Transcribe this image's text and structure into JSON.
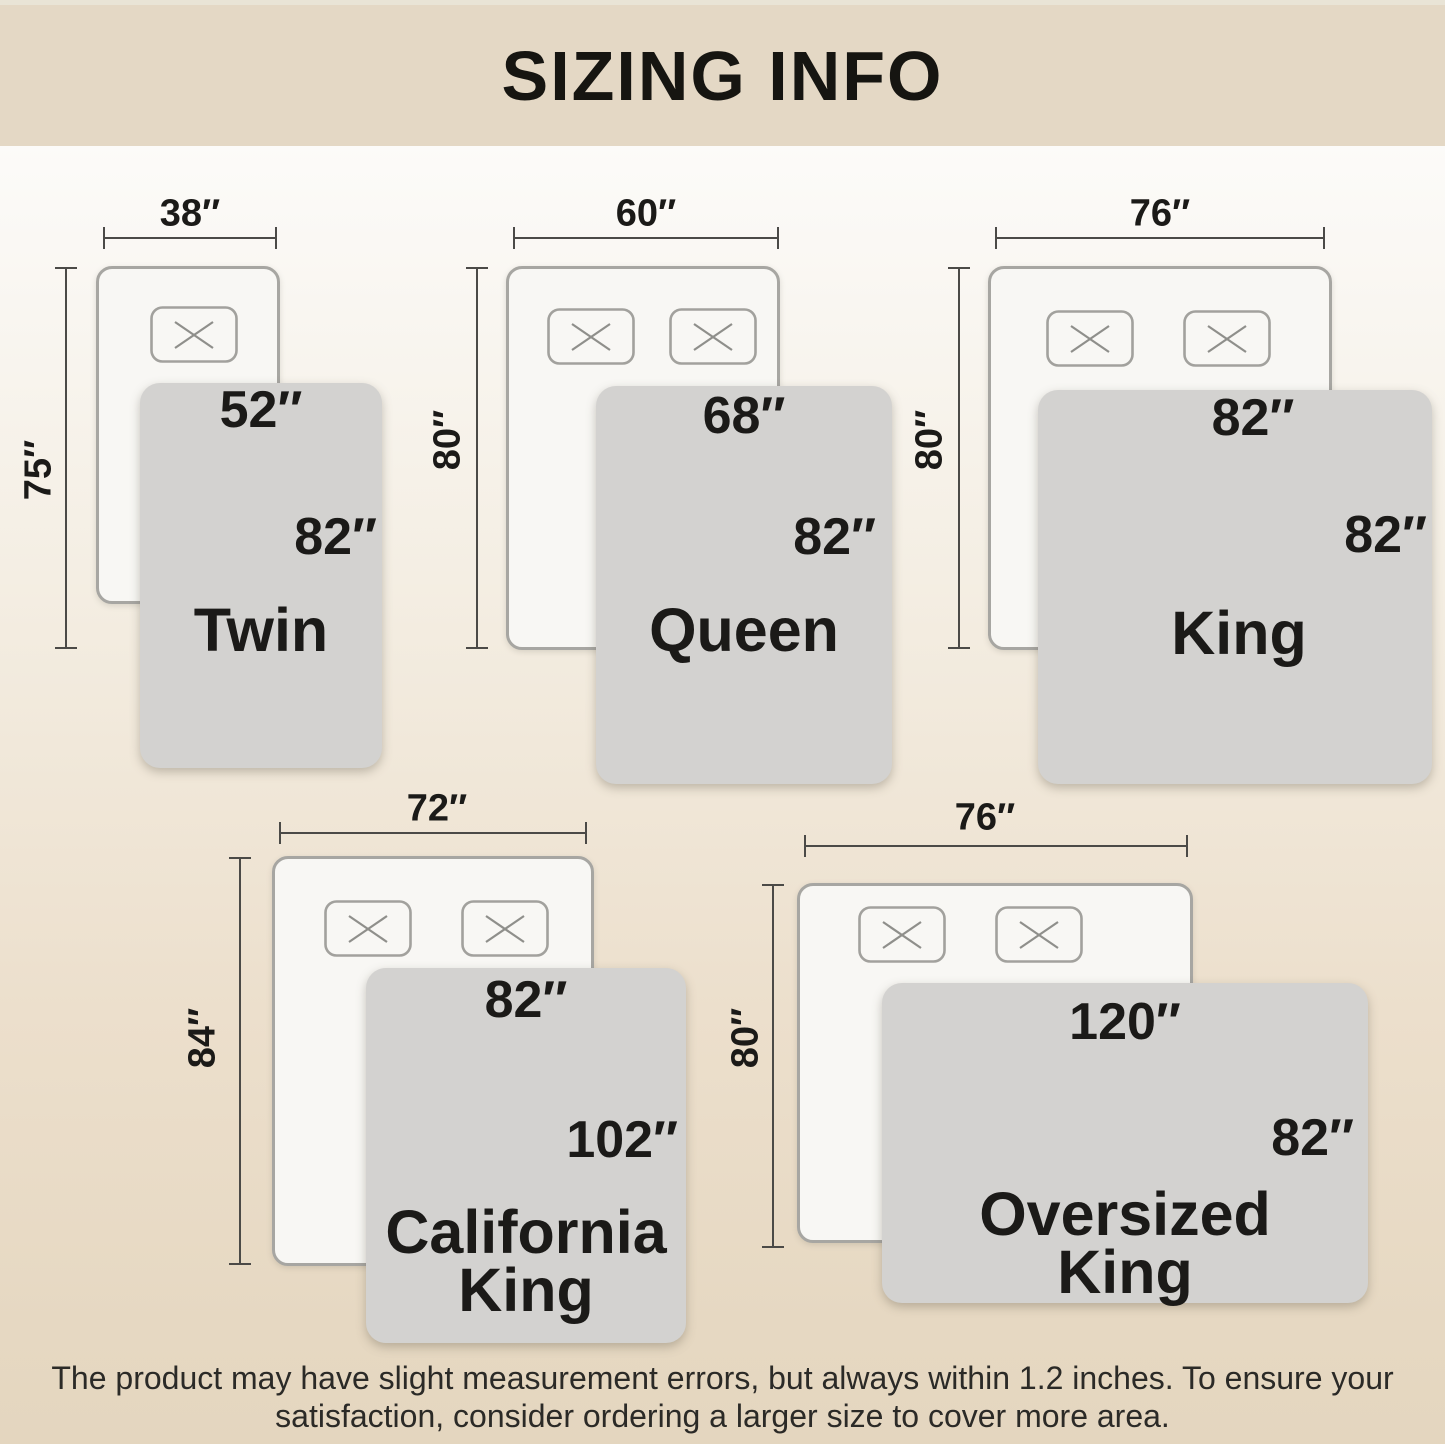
{
  "header": {
    "title": "SIZING INFO"
  },
  "footer": {
    "line1": "The product may have slight measurement errors, but always within 1.2 inches. To ensure your",
    "line2": "satisfaction, consider ordering a larger size to cover more area."
  },
  "colors": {
    "banner": "#e4d8c5",
    "background_top": "#fcfbf9",
    "background_bottom": "#e4d6bf",
    "mattress_fill": "#f8f7f4",
    "mattress_border": "#a7a6a2",
    "blanket_fill": "#d3d2d0",
    "dimension_line": "#4b4a47",
    "text": "#1b1a18"
  },
  "beds": [
    {
      "name_line1": "Twin",
      "name_line2": "",
      "mattress": {
        "width": "38″",
        "length": "75″"
      },
      "blanket": {
        "width": "52″",
        "length": "82″"
      }
    },
    {
      "name_line1": "Queen",
      "name_line2": "",
      "mattress": {
        "width": "60″",
        "length": "80″"
      },
      "blanket": {
        "width": "68″",
        "length": "82″"
      }
    },
    {
      "name_line1": "King",
      "name_line2": "",
      "mattress": {
        "width": "76″",
        "length": "80″"
      },
      "blanket": {
        "width": "82″",
        "length": "82″"
      }
    },
    {
      "name_line1": "California",
      "name_line2": "King",
      "mattress": {
        "width": "72″",
        "length": "84″"
      },
      "blanket": {
        "width": "82″",
        "length": "102″"
      }
    },
    {
      "name_line1": "Oversized",
      "name_line2": "King",
      "mattress": {
        "width": "76″",
        "length": "80″"
      },
      "blanket": {
        "width": "120″",
        "length": "82″"
      }
    }
  ]
}
